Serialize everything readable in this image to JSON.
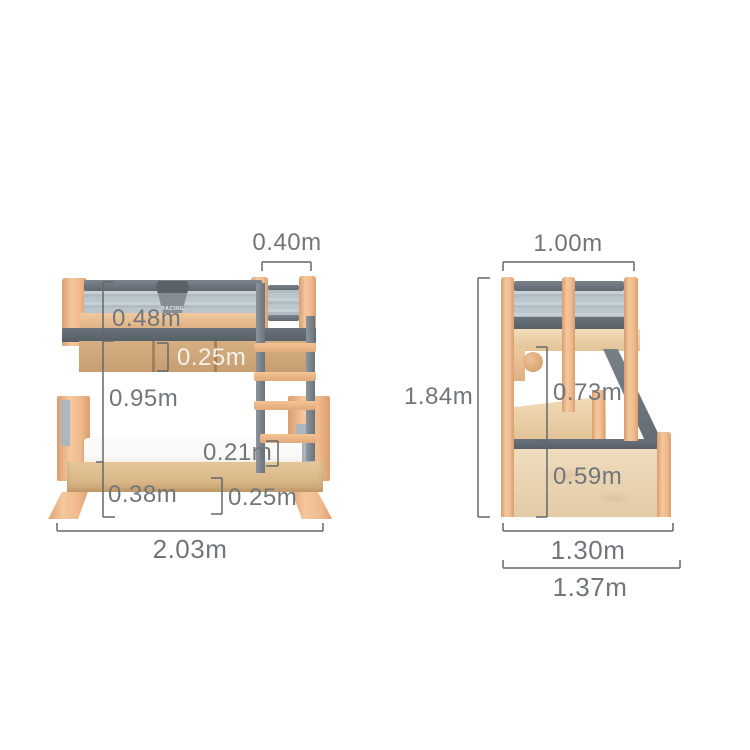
{
  "canvas": {
    "width": 750,
    "height": 750,
    "background": "#ffffff"
  },
  "front_view": {
    "badge_text": "RACING",
    "ladder_width_label": "0.40m",
    "guardrail_height_label": "0.48m",
    "frame_panel_height_label": "0.25m",
    "underbed_clearance_label": "0.95m",
    "rung_height_label": "0.21m",
    "base_height_label": "0.38m",
    "base_clearance_label": "0.25m",
    "overall_width_label": "2.03m"
  },
  "side_view": {
    "top_width_label": "1.00m",
    "overall_height_label": "1.84m",
    "bunk_clearance_label": "0.73m",
    "storage_height_label": "0.59m",
    "bed_depth_label": "1.30m",
    "overall_depth_label": "1.37m"
  },
  "colors": {
    "wood": "#efbb90",
    "wood_dark": "#cda47a",
    "rail_gray": "#646d75",
    "panel_blue_gray": "#b8c3cb",
    "mattress_white": "#f8f6f3",
    "dimension_text": "#71767b",
    "dimension_line": "#63686d"
  }
}
